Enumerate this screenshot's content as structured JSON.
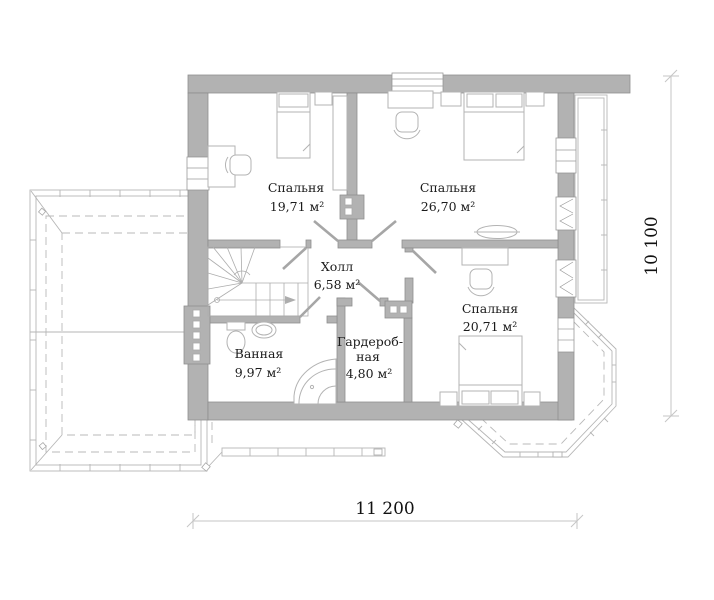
{
  "plan": {
    "type": "second-floor-plan",
    "rooms": {
      "bedroom1": {
        "name": "Спальня",
        "area": "19,71 м²"
      },
      "bedroom2": {
        "name": "Спальня",
        "area": "26,70 м²"
      },
      "bedroom3": {
        "name": "Спальня",
        "area": "20,71 м²"
      },
      "hall": {
        "name": "Холл",
        "area": "6,58 м²"
      },
      "wardrobe": {
        "name_line1": "Гардероб-",
        "name_line2": "ная",
        "area": "4,80 м²"
      },
      "bathroom": {
        "name": "Ванная",
        "area": "9,97 м²"
      }
    },
    "dimensions": {
      "width_label": "11 200",
      "height_label": "10 100"
    },
    "colors": {
      "wall_fill": "#b2b2b2",
      "wall_outline": "#8e8e8e",
      "furniture_line": "#b3b3b3",
      "roof_line": "#b6b6b6",
      "dimension_line": "#c6c6c6",
      "text": "#1b1b1b"
    }
  }
}
